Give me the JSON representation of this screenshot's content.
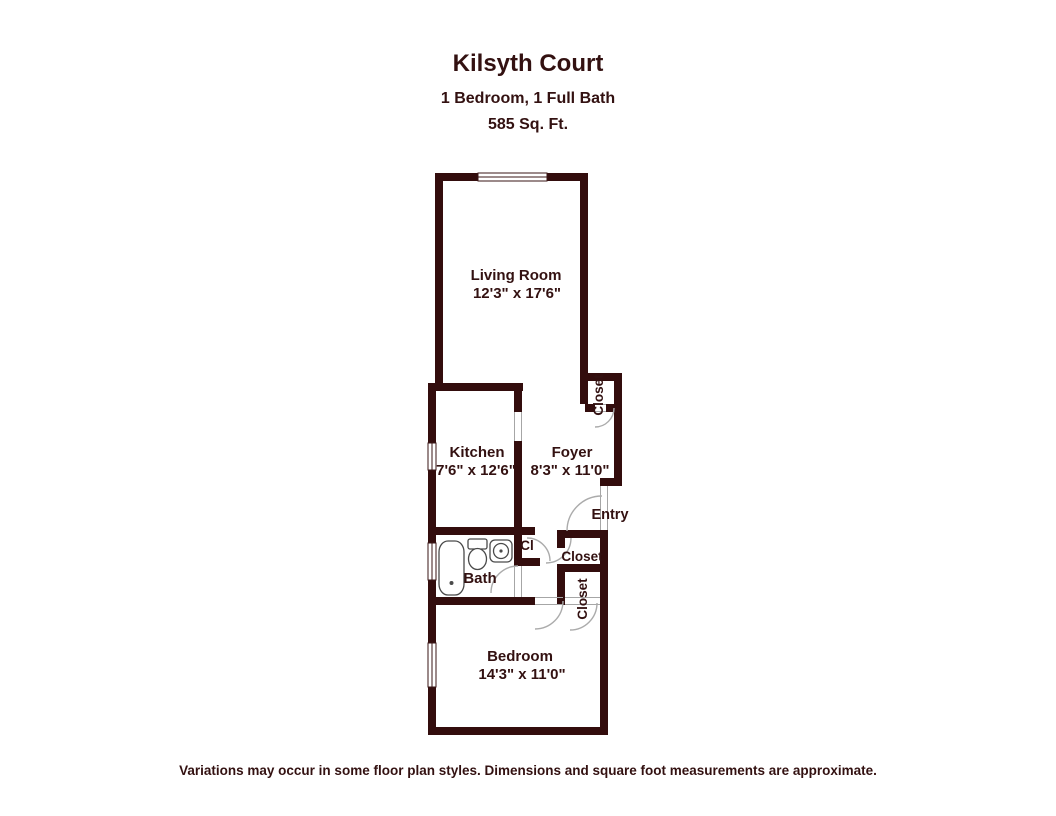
{
  "header": {
    "title": "Kilsyth Court",
    "subtitle": "1 Bedroom, 1 Full Bath",
    "area": "585 Sq. Ft."
  },
  "rooms": [
    {
      "name": "Living Room",
      "dimensions": "12'3\" x 17'6\""
    },
    {
      "name": "Kitchen",
      "dimensions": "7'6\" x 12'6\""
    },
    {
      "name": "Foyer",
      "dimensions": "8'3\" x 11'0\""
    },
    {
      "name": "Bath",
      "dimensions": ""
    },
    {
      "name": "Bedroom",
      "dimensions": "14'3\" x 11'0\""
    }
  ],
  "labels": {
    "entry": "Entry",
    "closet_top_right": "Closet",
    "closet_upper": "Closet",
    "closet_lower": "Closet",
    "closet_small": "Cl"
  },
  "footer": {
    "disclaimer": "Variations may occur in some floor plan styles. Dimensions and square foot measurements are approximate."
  },
  "colors": {
    "wall": "#330d0d",
    "text": "#331111",
    "door_arc": "#ababab",
    "fixture_outline": "#4a4a4a",
    "background": "#ffffff"
  }
}
